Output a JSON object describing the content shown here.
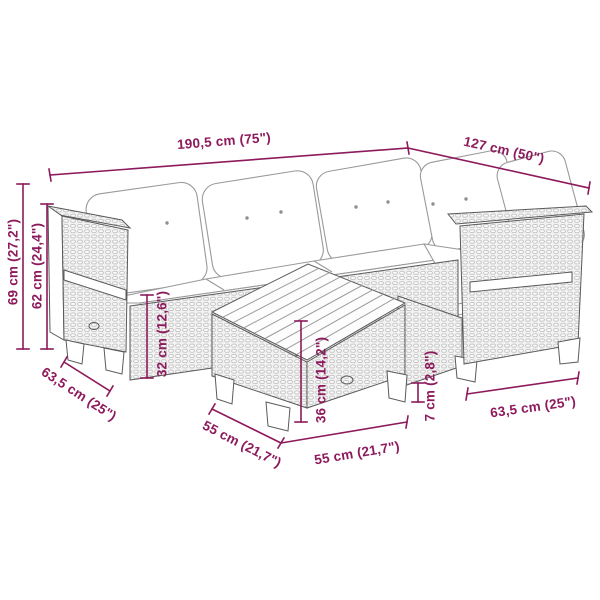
{
  "colors": {
    "dimension_accent": "#8d1a5c",
    "drawing_line": "#5a5a5a",
    "rattan_fill": "#f2f2f2",
    "cushion_outline": "#9a9a9a"
  },
  "dimensions": {
    "total_length": "190,5 cm (75\")",
    "right_side_length": "127 cm (50\")",
    "total_height": "69 cm (27,2\")",
    "backrest_height": "62 cm (24,4\")",
    "left_module_depth": "63,5 cm (25\")",
    "seat_height": "32 cm (12,6\")",
    "table_height": "36 cm (14,2\")",
    "table_ground_clearance": "7 cm (2,8\")",
    "table_depth": "55 cm (21,7\")",
    "table_width": "55 cm (21,7\")",
    "right_module_depth": "63,5 cm (25\")"
  }
}
